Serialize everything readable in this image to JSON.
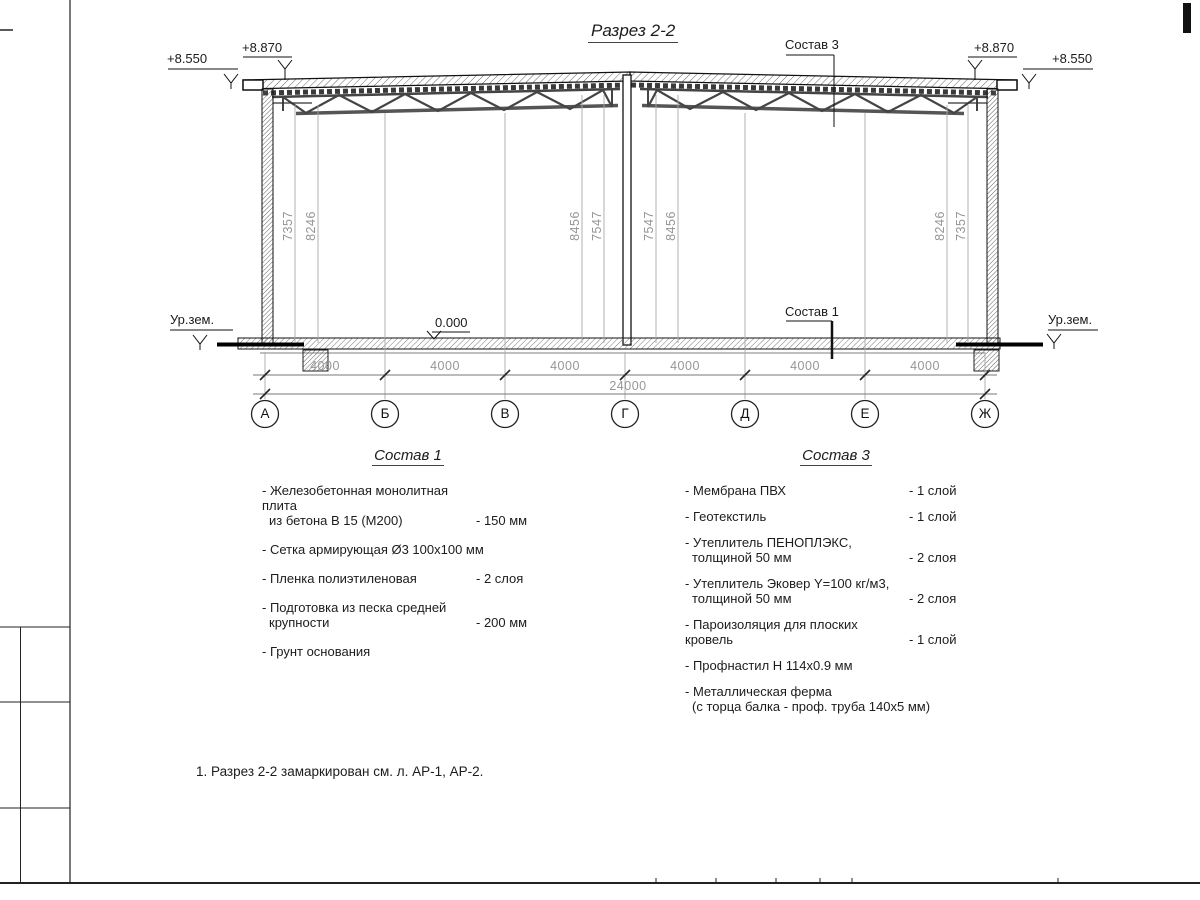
{
  "sheet": {
    "title": "Разрез 2-2",
    "note": "1. Разрез 2-2 замаркирован см. л. АР-1, АР-2."
  },
  "callouts": {
    "sostav3": "Состав 3",
    "sostav1": "Состав 1"
  },
  "elevations": {
    "left_outer": "+8.550",
    "left_inner": "+8.870",
    "right_inner": "+8.870",
    "right_outer": "+8.550",
    "ground_left": "Ур.зем.",
    "ground_right": "Ур.зем.",
    "floor_zero": "0.000"
  },
  "vertical_dims": [
    "7357",
    "8246",
    "8456",
    "7547",
    "7547",
    "8456",
    "8246",
    "7357"
  ],
  "dims": {
    "bays": [
      "4000",
      "4000",
      "4000",
      "4000",
      "4000",
      "4000"
    ],
    "total": "24000"
  },
  "axes": [
    "А",
    "Б",
    "В",
    "Г",
    "Д",
    "Е",
    "Ж"
  ],
  "sostav1": {
    "heading": "Состав 1",
    "items": [
      {
        "line1": "- Железобетонная  монолитная плита",
        "line2": "из бетона В 15 (М200)",
        "value": "- 150 мм"
      },
      {
        "line1": "- Сетка армирующая Ø3 100x100 мм",
        "line2": "",
        "value": ""
      },
      {
        "line1": "- Пленка полиэтиленовая",
        "line2": "",
        "value": "-  2 слоя"
      },
      {
        "line1": "- Подготовка из песка средней",
        "line2": "крупности",
        "value": "- 200 мм"
      },
      {
        "line1": "- Грунт основания",
        "line2": "",
        "value": ""
      }
    ]
  },
  "sostav3": {
    "heading": "Состав 3",
    "items": [
      {
        "line1": "- Мембрана ПВХ",
        "line2": "",
        "value": "- 1 слой"
      },
      {
        "line1": "- Геотекстиль",
        "line2": "",
        "value": "- 1 слой"
      },
      {
        "line1": "- Утеплитель ПЕНОПЛЭКС,",
        "line2": "толщиной 50 мм",
        "value": "- 2 слоя"
      },
      {
        "line1": "- Утеплитель Эковер Y=100 кг/м3,",
        "line2": "толщиной 50 мм",
        "value": "- 2 слоя"
      },
      {
        "line1": "- Пароизоляция для плоских кровель",
        "line2": "",
        "value": "- 1 слой"
      },
      {
        "line1": "- Профнастил Н 114x0.9 мм",
        "line2": "",
        "value": ""
      },
      {
        "line1": "- Металлическая ферма",
        "line2": "(с торца балка - проф. труба 140x5 мм)",
        "value": ""
      }
    ]
  }
}
